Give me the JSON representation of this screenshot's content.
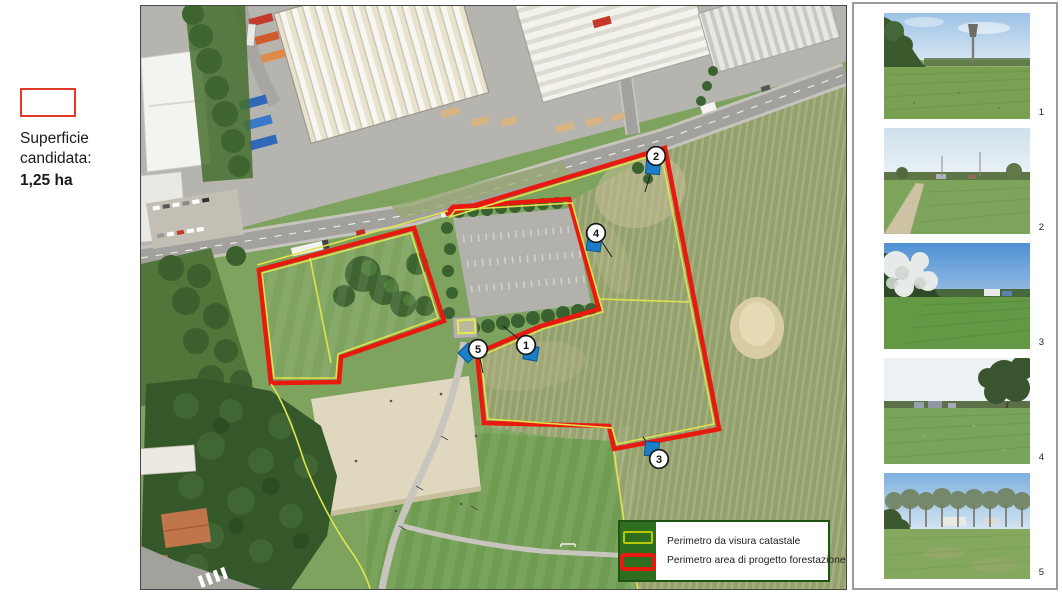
{
  "annotation": {
    "line1": "Superficie",
    "line2": "candidata:",
    "value": "1,25 ha",
    "swatch_color": "#e0392a"
  },
  "map": {
    "colors": {
      "perimeter_red": "#e8190f",
      "catastale_yellow": "#dfe34e",
      "marker_blue": "#1a7ec8",
      "legend_green": "#2e6e1f"
    },
    "legend": {
      "items": [
        {
          "label": "Perimetro da visura catastale",
          "type": "catastale"
        },
        {
          "label": "Perimetro area di progetto forestazione",
          "type": "forestazione"
        }
      ]
    },
    "markers": [
      {
        "n": "1",
        "cx": 385,
        "cy": 339,
        "flag": {
          "x": 390,
          "y": 347,
          "rot": 10
        },
        "leader": [
          362,
          320
        ]
      },
      {
        "n": "2",
        "cx": 515,
        "cy": 150,
        "flag": {
          "x": 512,
          "y": 161,
          "rot": 5
        },
        "leader": [
          504,
          186
        ]
      },
      {
        "n": "3",
        "cx": 518,
        "cy": 453,
        "flag": {
          "x": 511,
          "y": 443,
          "rot": 5
        },
        "leader": [
          502,
          431
        ]
      },
      {
        "n": "4",
        "cx": 455,
        "cy": 227,
        "flag": {
          "x": 453,
          "y": 238,
          "rot": 8
        },
        "leader": [
          471,
          251
        ]
      },
      {
        "n": "5",
        "cx": 337,
        "cy": 343,
        "flag": {
          "x": 327,
          "y": 347,
          "rot": 45
        },
        "leader": [
          342,
          367
        ]
      }
    ]
  },
  "sidebar": {
    "photos": [
      {
        "number": "1",
        "desc": "meadow with water tower on horizon"
      },
      {
        "number": "2",
        "desc": "field with dirt path and tree line"
      },
      {
        "number": "3",
        "desc": "flowering white trees beside meadow"
      },
      {
        "number": "4",
        "desc": "green field with large tree at right"
      },
      {
        "number": "5",
        "desc": "grassland with row of bare trees"
      }
    ]
  }
}
